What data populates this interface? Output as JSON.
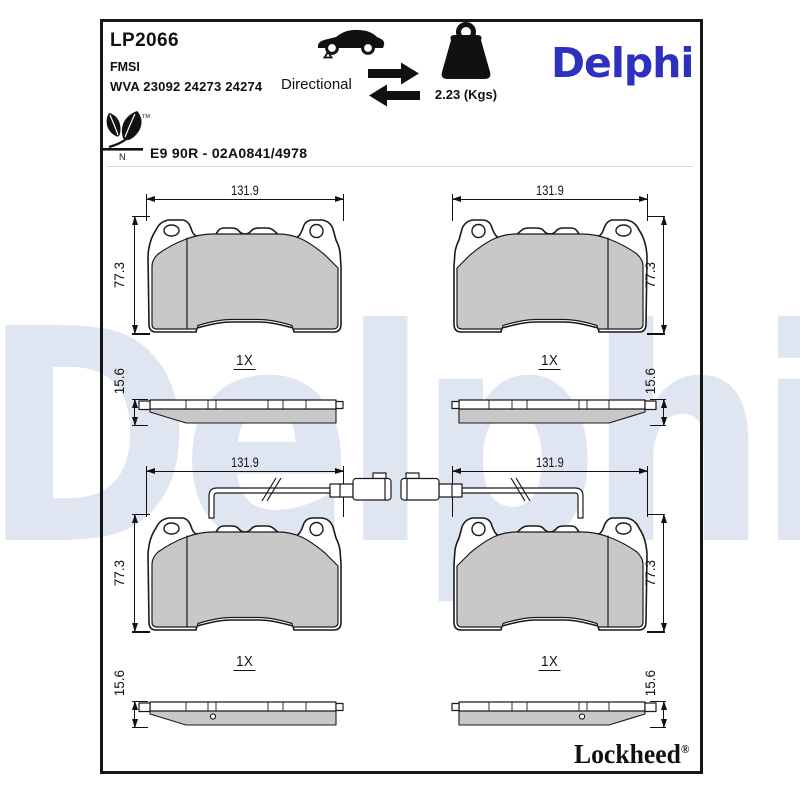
{
  "header": {
    "part_number": "LP2066",
    "fmsi_label": "FMSI",
    "wva_numbers": "WVA 23092 24273 24274",
    "directional_label": "Directional",
    "weight_value": "2.23 (Kgs)",
    "brand_logo": "Delphi",
    "eco_trademark": "TM",
    "eco_letter": "N",
    "approval_code": "E9 90R - 02A0841/4978"
  },
  "watermark": "Delphi",
  "footer": {
    "brand_logo": "Lockheed",
    "registered_mark": "®"
  },
  "drawings": {
    "pads": [
      {
        "position": "top-left",
        "width": "131.9",
        "height": "77.3",
        "thickness": "15.6",
        "quantity": "1X"
      },
      {
        "position": "top-right",
        "width": "131.9",
        "height": "77.3",
        "thickness": "15.6",
        "quantity": "1X"
      },
      {
        "position": "bottom-left",
        "width": "131.9",
        "height": "77.3",
        "thickness": "15.6",
        "quantity": "1X"
      },
      {
        "position": "bottom-right",
        "width": "131.9",
        "height": "77.3",
        "thickness": "15.6",
        "quantity": "1X"
      }
    ]
  },
  "colors": {
    "brand_blue": "#2d31bd",
    "watermark_blue": "#e0e6f1",
    "friction_gray": "#c8c8c8",
    "line": "#1a1a1a"
  }
}
